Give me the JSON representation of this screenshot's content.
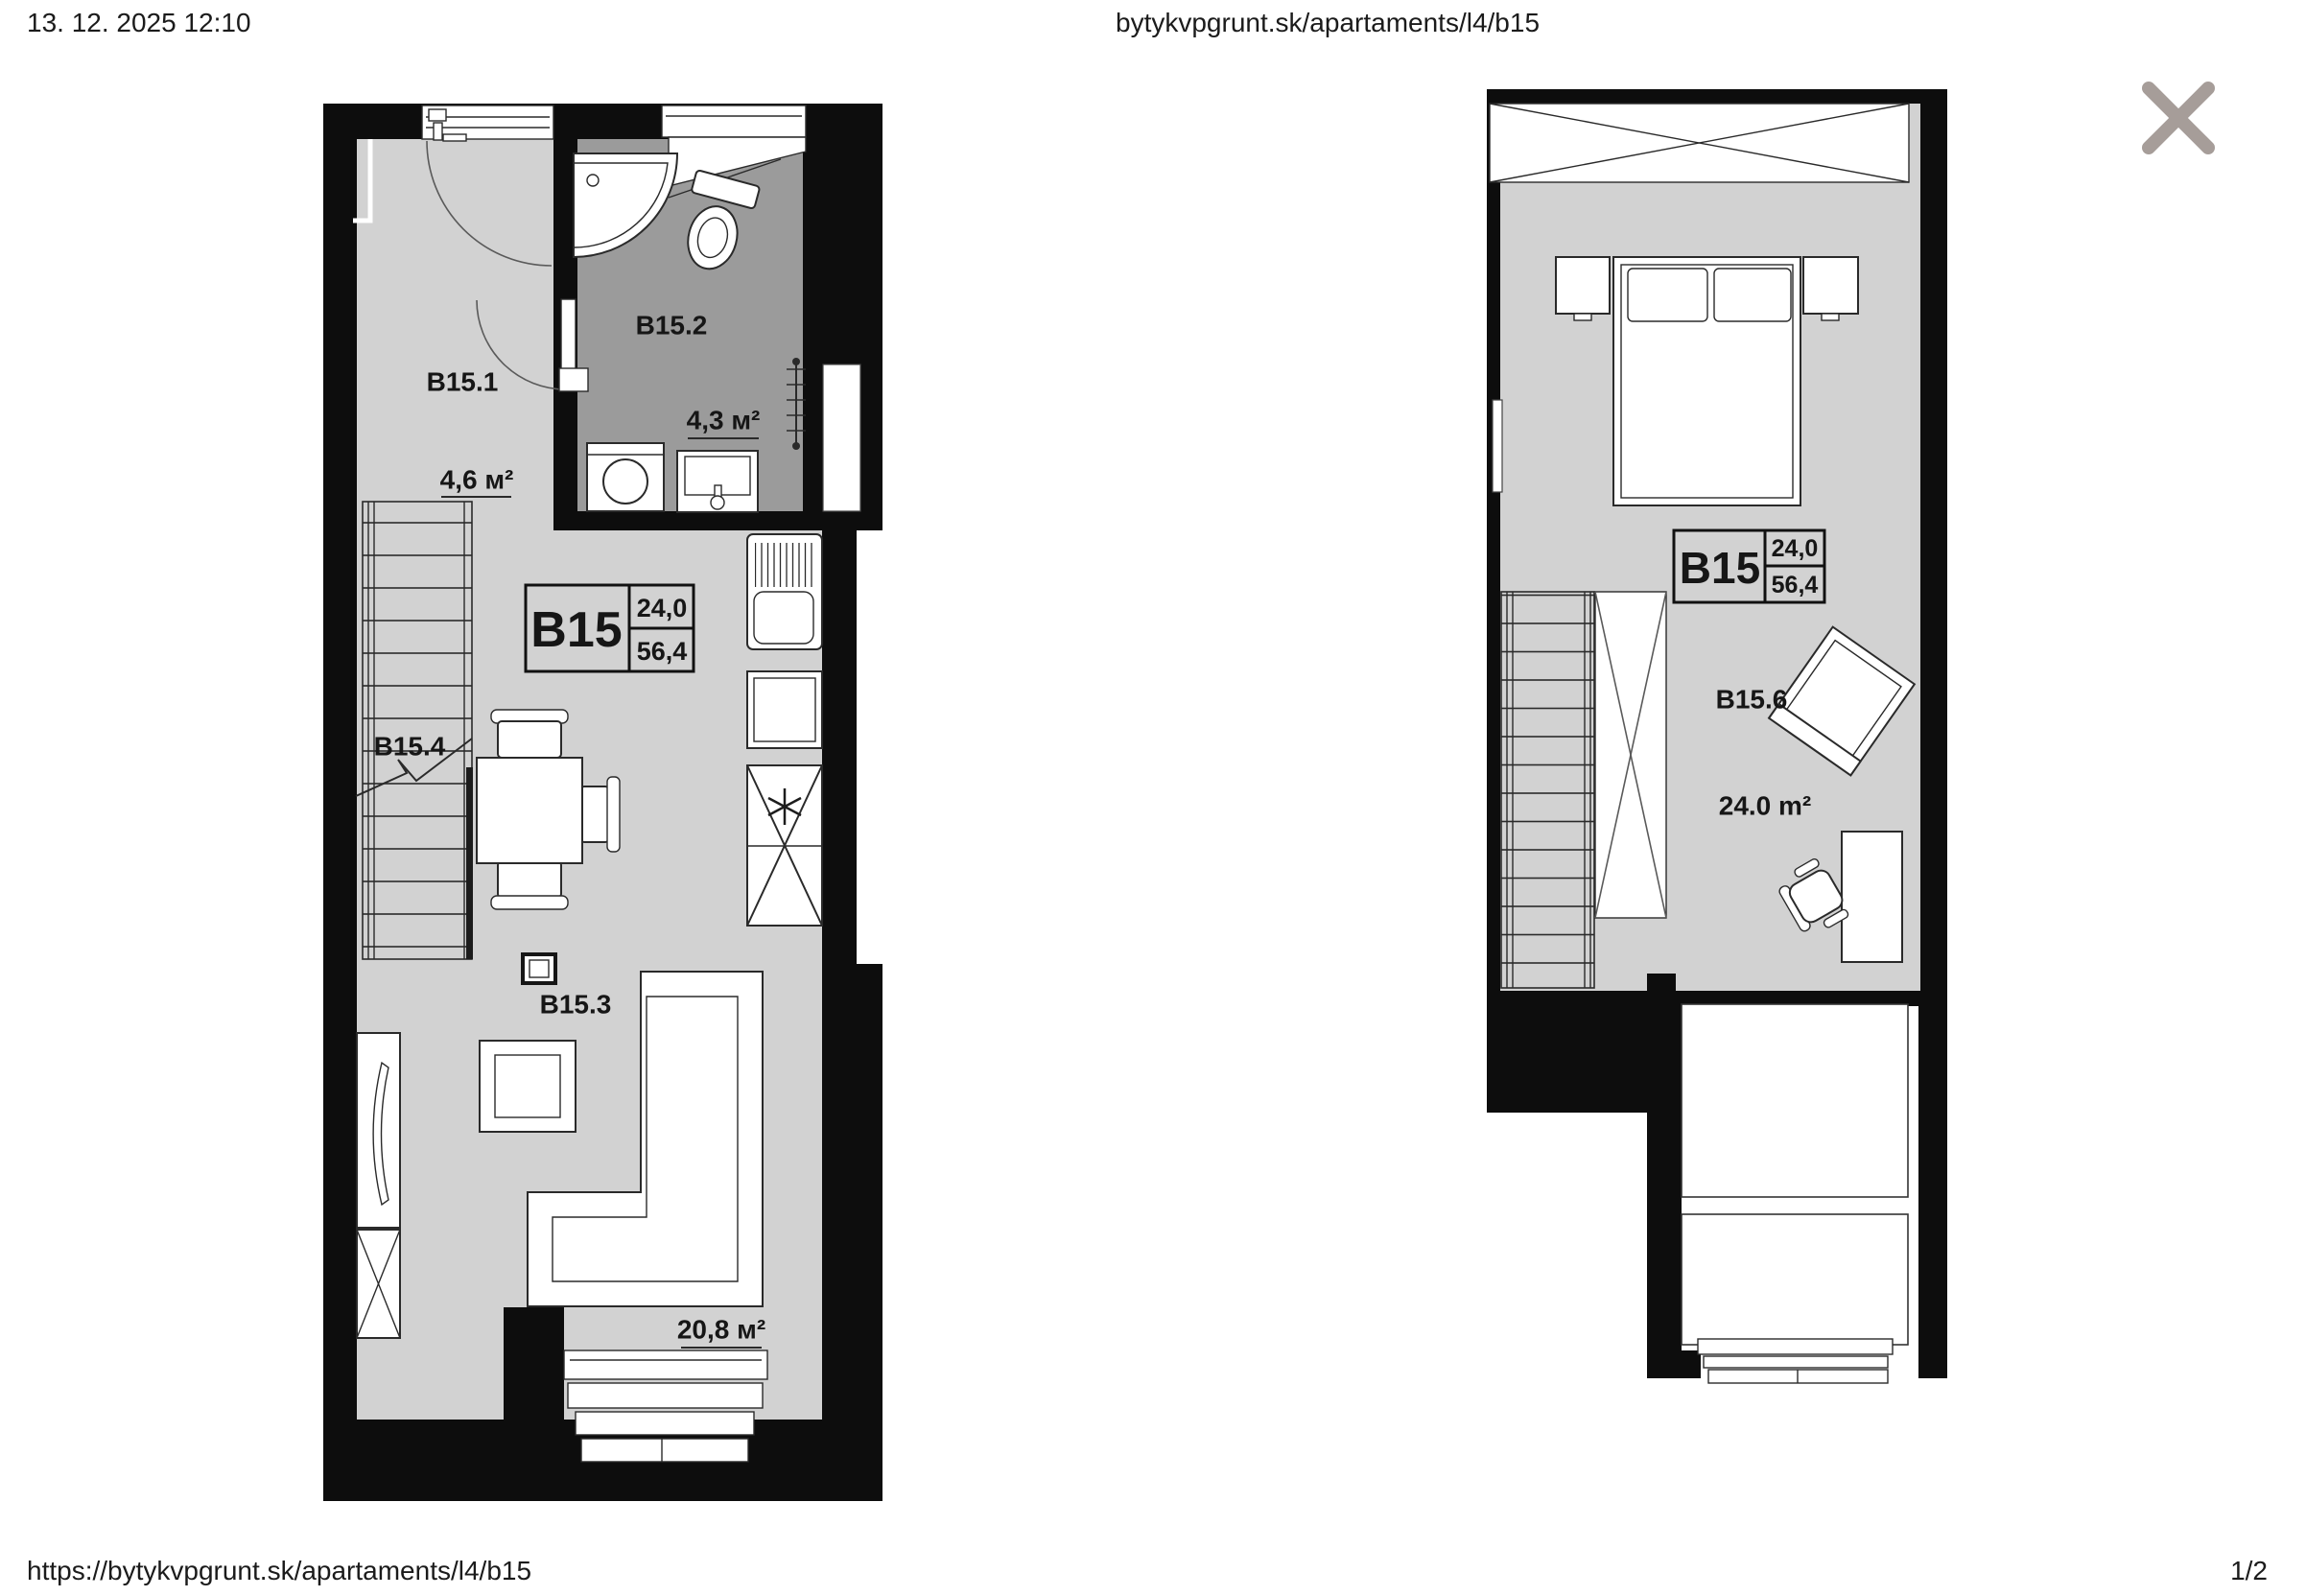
{
  "print_header": {
    "datetime": "13. 12. 2025 12:10",
    "page_title": "bytykvpgrunt.sk/apartaments/l4/b15"
  },
  "print_footer": {
    "url": "https://bytykvpgrunt.sk/apartaments/l4/b15",
    "page_number": "1/2"
  },
  "close_button": {
    "label": "close"
  },
  "colors": {
    "wall": "#0d0d0d",
    "floor": "#d2d2d2",
    "bath": "#9b9b9b",
    "line": "#2a2a2a",
    "close": "#a69d99",
    "text": "#1b1b1b"
  },
  "plan1": {
    "unit_box": {
      "unit": "B15",
      "value_top": "24,0",
      "value_bottom": "56,4"
    },
    "rooms": {
      "hall": {
        "label": "B15.1",
        "area": "4,6 м²"
      },
      "bathroom": {
        "label": "B15.2",
        "area": "4,3 м²"
      },
      "living": {
        "label": "B15.3",
        "area": "20,8 м²"
      },
      "stairs": {
        "label": "B15.4"
      }
    }
  },
  "plan2": {
    "unit_box": {
      "unit": "B15",
      "value_top": "24,0",
      "value_bottom": "56,4"
    },
    "rooms": {
      "room": {
        "label": "B15.6",
        "area": "24.0 m²"
      }
    }
  }
}
